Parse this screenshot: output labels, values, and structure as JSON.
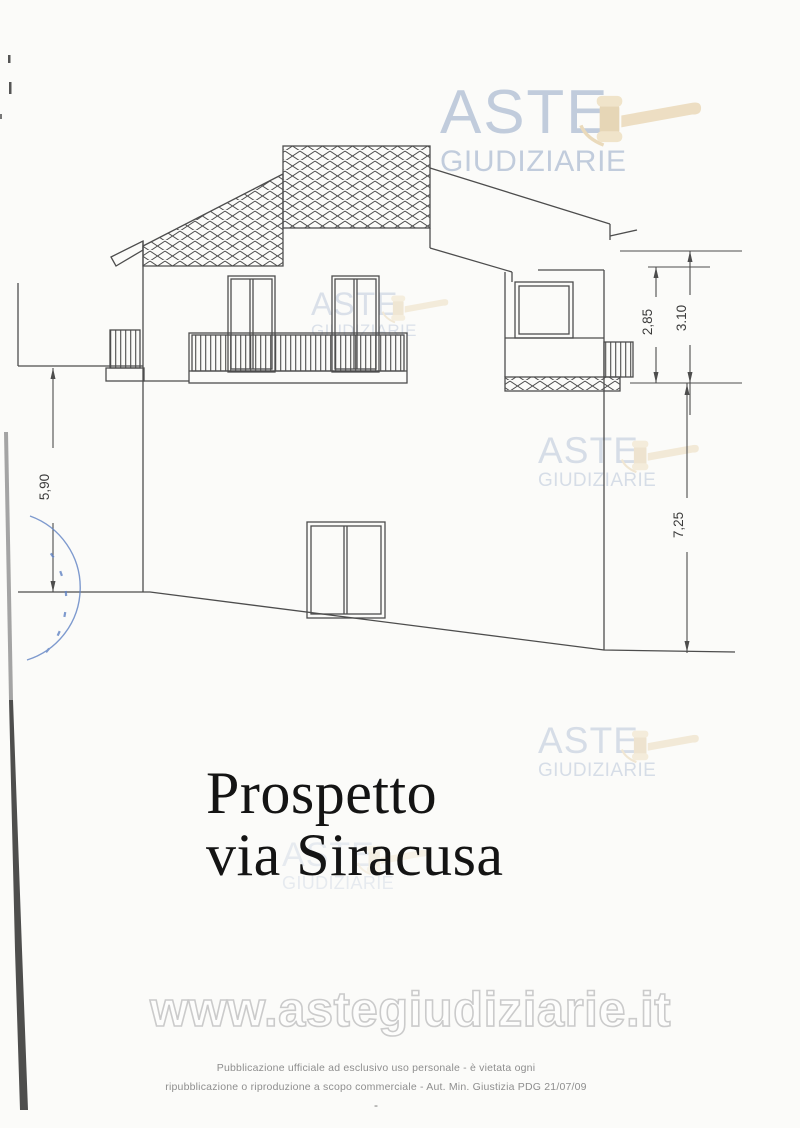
{
  "scan": {
    "title": {
      "line1": "Prospetto",
      "line2": "via Siracusa"
    },
    "dimensions": {
      "balcony_height": "2,85",
      "floor_height": "3.10",
      "left_wall_height": "5,90",
      "right_wall_height": "7,25"
    },
    "branding": {
      "word1": "ASTE",
      "word2": "GIUDIZIARIE"
    },
    "url_watermark": "www.astegiudiziarie.it",
    "footer": {
      "line1": "Pubblicazione ufficiale ad esclusivo uso personale - è vietata ogni",
      "line2": "ripubblicazione o riproduzione a scopo commerciale - Aut. Min. Giustizia PDG 21/07/09",
      "dash": "-"
    },
    "colors": {
      "logo_blue": "#b3c1d6",
      "gavel_tan": "#e8d4b0",
      "stamp_blue": "#5f82c4",
      "line_gray": "#4d4d4d"
    }
  }
}
